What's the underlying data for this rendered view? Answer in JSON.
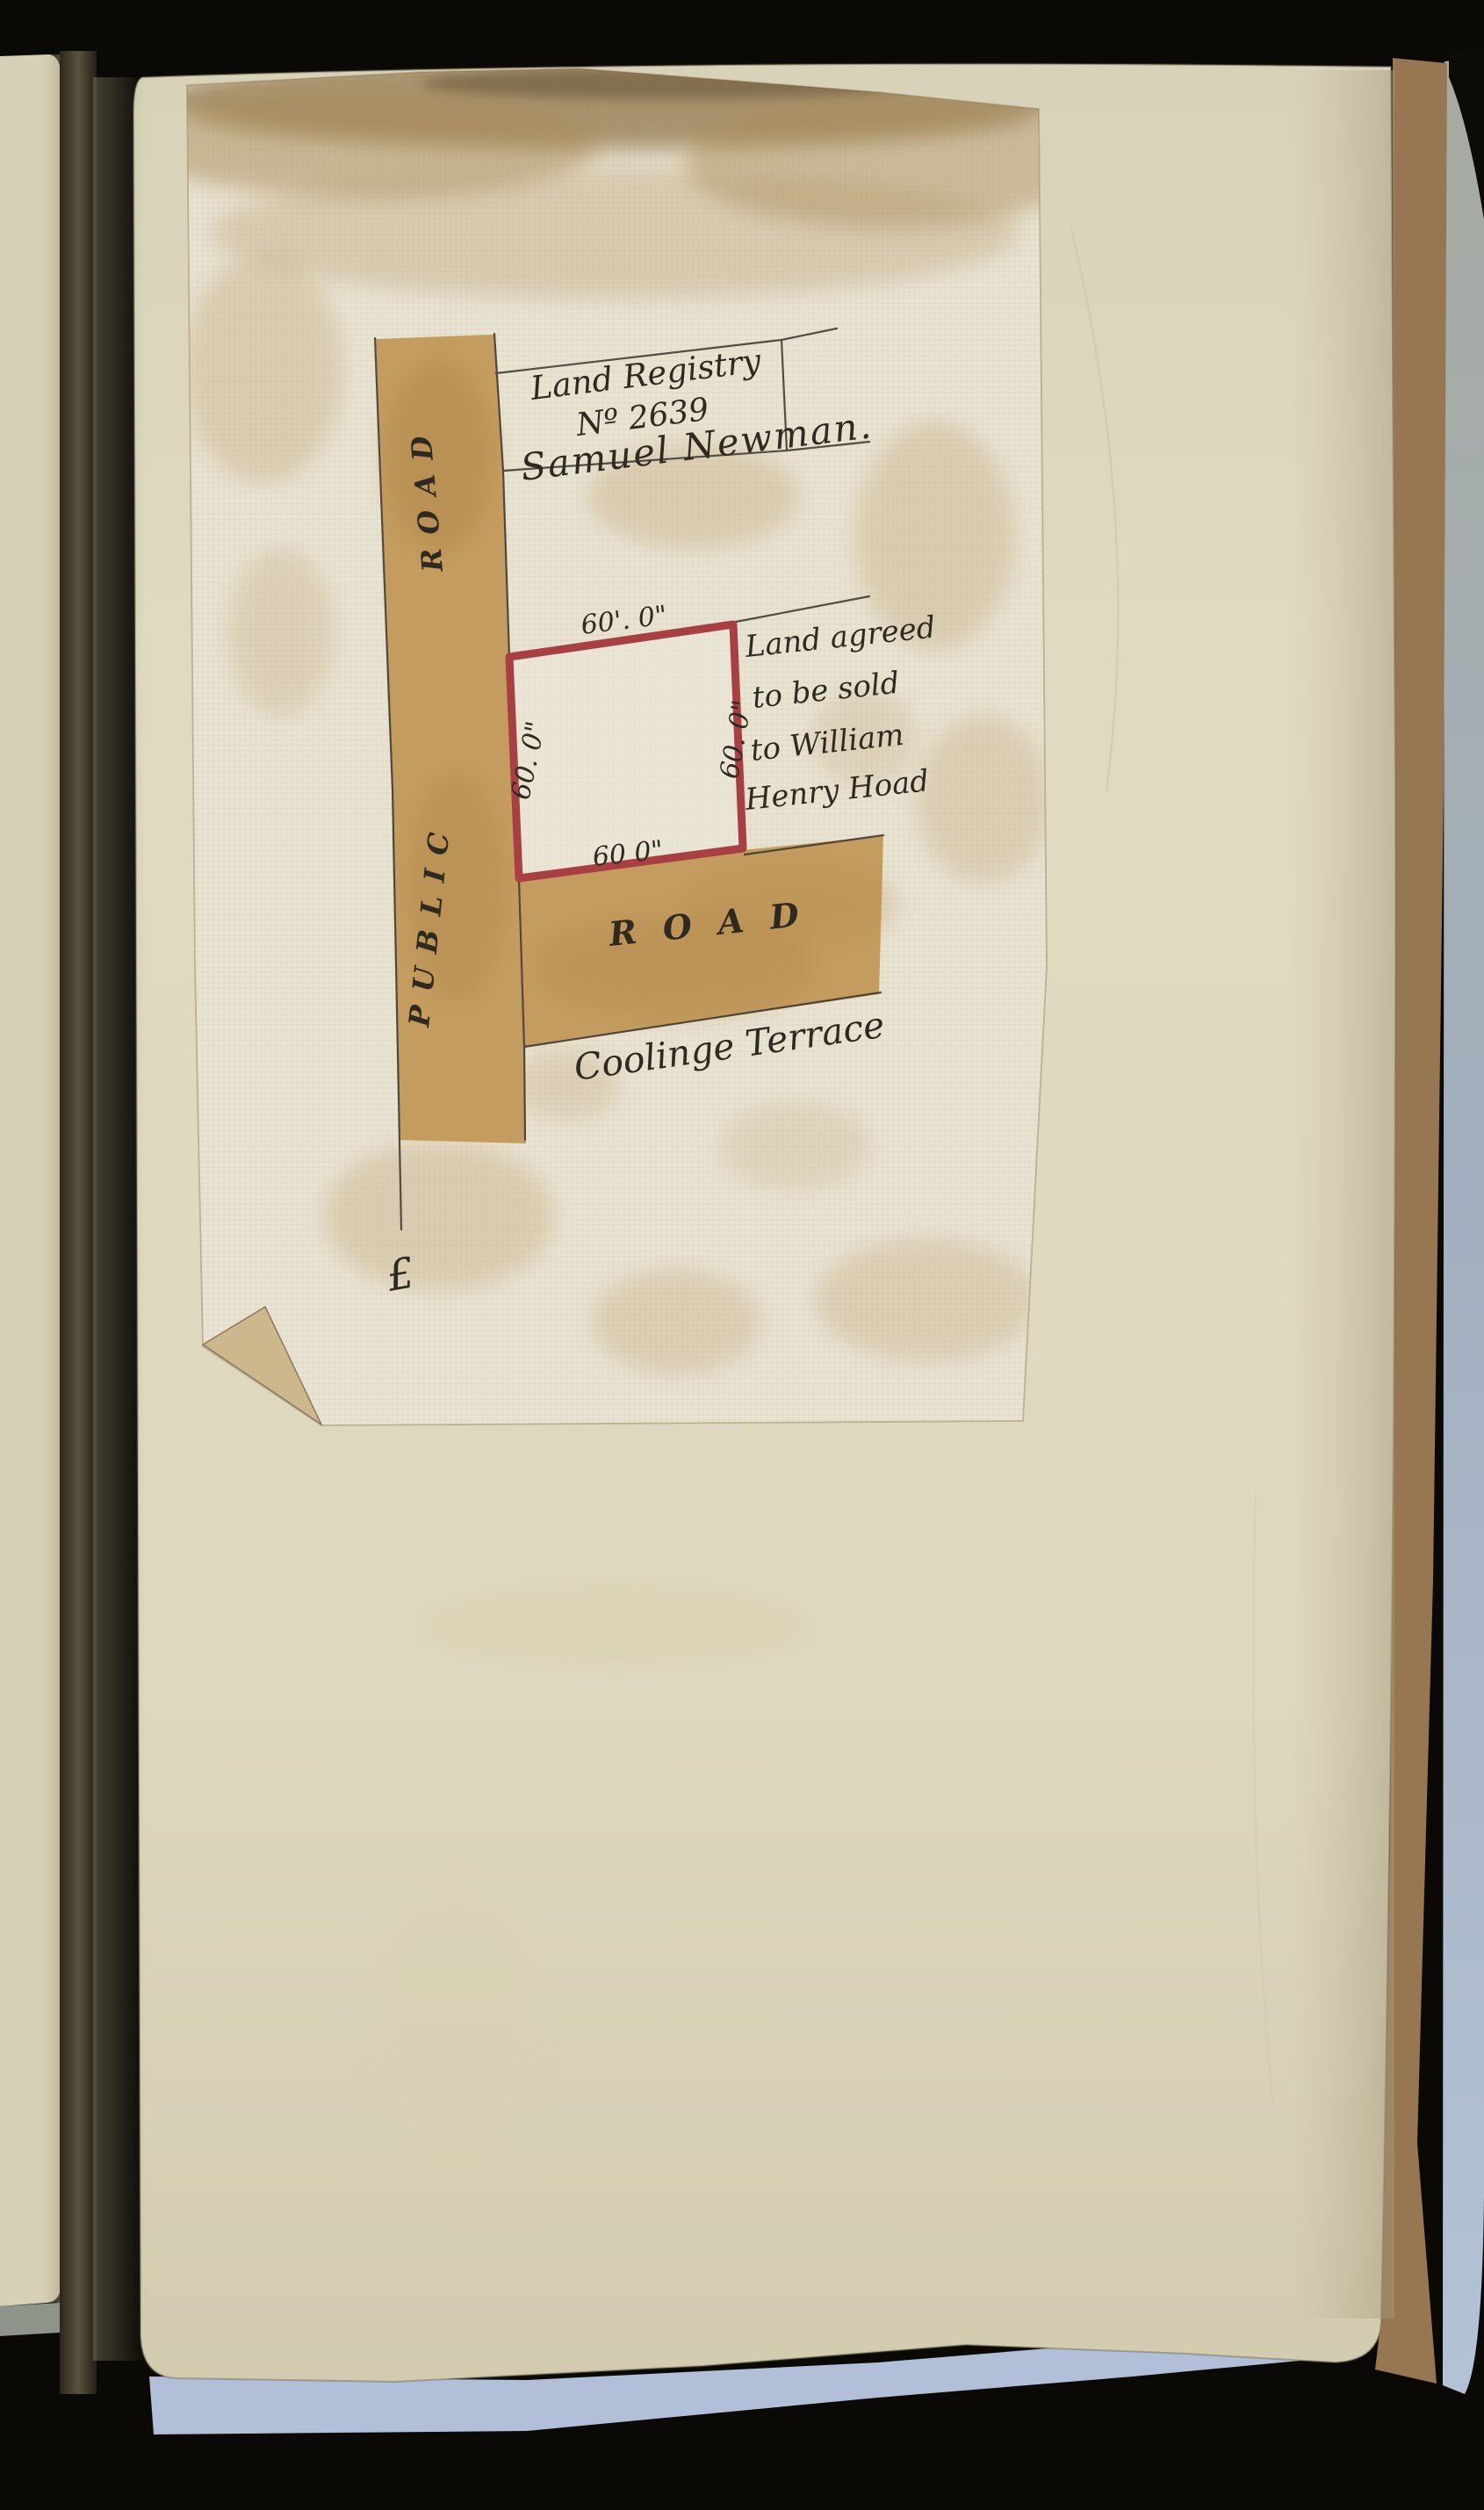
{
  "map": {
    "registry": {
      "line1": "Land Registry",
      "line2": "Nº 2639",
      "owner": "Samuel Newman."
    },
    "plot": {
      "dim_top": "60'. 0\"",
      "dim_left": "60. 0\"",
      "dim_right": "60. 0\"",
      "dim_bottom": "60  0\""
    },
    "note": [
      "Land agreed",
      "to be sold",
      "to William",
      "Henry Hoad"
    ],
    "roads": {
      "vertical_word1": "ROAD",
      "vertical_word2": "PUBLIC",
      "horizontal": "ROAD",
      "street": "Coolinge Terrace"
    },
    "flourish": "£",
    "colors": {
      "plot_outline": "#a84043",
      "road_wash": "#c59c5f",
      "linen_sheet": "#e9e3d2",
      "album_page": "#ded8be",
      "ink": "#3f3830",
      "under_page_blue": "#b2bfd8",
      "stack_edge_brown": "#977752",
      "stack_edge_gray": "#a8b2bc",
      "backdrop": "#0b0906"
    }
  }
}
